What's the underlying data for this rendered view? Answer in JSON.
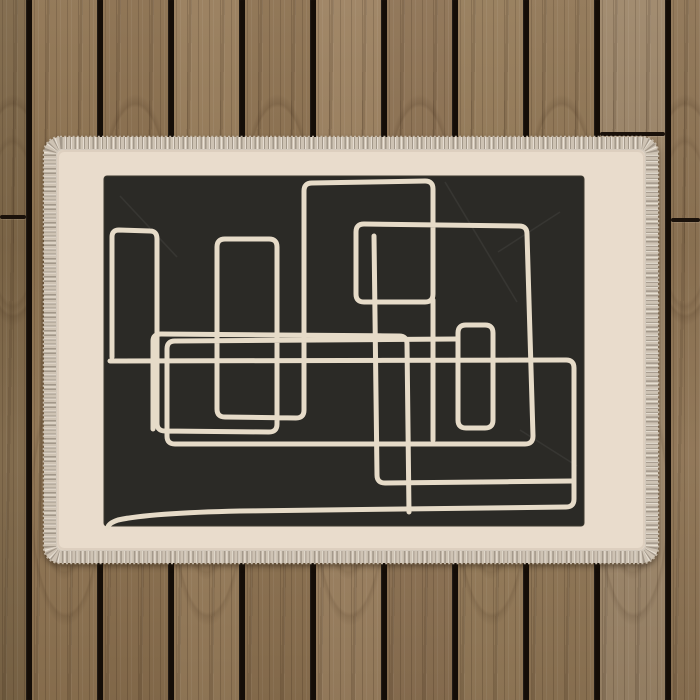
{
  "scene": {
    "description": "Abstract single-line art rug with black canvas and cream border, photographed on a brown wooden deck of vertical planks",
    "wood": {
      "gap_color": "#140d07",
      "gap_width": 6,
      "seam_color": "#1a110a",
      "planks": [
        {
          "x": 0,
          "w": 26,
          "color": "#7e6748"
        },
        {
          "x": 32,
          "w": 65,
          "color": "#8f7452"
        },
        {
          "x": 103,
          "w": 65,
          "color": "#8a6f4e"
        },
        {
          "x": 174,
          "w": 65,
          "color": "#977c5a"
        },
        {
          "x": 245,
          "w": 65,
          "color": "#8c7150"
        },
        {
          "x": 316,
          "w": 65,
          "color": "#9c8160"
        },
        {
          "x": 387,
          "w": 65,
          "color": "#8d7253"
        },
        {
          "x": 458,
          "w": 65,
          "color": "#957b59"
        },
        {
          "x": 529,
          "w": 65,
          "color": "#907655"
        },
        {
          "x": 600,
          "w": 65,
          "color": "#9d8669"
        },
        {
          "x": 671,
          "w": 29,
          "color": "#8e7454"
        }
      ],
      "gap_centers": [
        29,
        100,
        171,
        242,
        313,
        384,
        455,
        526,
        597,
        668
      ],
      "seams": [
        {
          "plank_index": 0,
          "y": 215
        },
        {
          "plank_index": 9,
          "y": 132
        },
        {
          "plank_index": 10,
          "y": 218
        }
      ]
    },
    "rug": {
      "outer": {
        "x": 44,
        "y": 137,
        "w": 614,
        "h": 426,
        "rx": 16
      },
      "fringe_color": "#d3c9bc",
      "fringe_edge_color": "#c4b8a7",
      "stitch_band": {
        "x": 50,
        "y": 143,
        "w": 602,
        "h": 414,
        "rx": 11,
        "width": 12,
        "base_color": "#cec3b4",
        "tick_color": "#a3988a",
        "highlight_color": "#f0e9dd"
      },
      "border_field": {
        "x": 57,
        "y": 150,
        "w": 588,
        "h": 400,
        "rx": 6,
        "color": "#e9dccc"
      },
      "canvas": {
        "x": 104,
        "y": 176,
        "w": 480,
        "h": 350,
        "rx": 3,
        "color": "#2b2a26",
        "edge_color": "#3c392f"
      },
      "line_color": "#e6dbc8",
      "line_width": 5,
      "art_paths": [
        "M 112,357 L 112,237 Q 112,230 119,230 L 150,231 Q 157,231 157,239 L 157,423 Q 157,431 165,431 L 269,432 Q 277,432 277,424 L 277,247 Q 277,239 269,239 L 225,239 Q 217,239 217,247 L 217,409 Q 217,417 225,417 L 296,418 Q 304,418 304,410 L 304,191 Q 304,183 312,183 L 425,181 Q 433,181 433,189 L 433,294 Q 433,302 425,302 L 364,302 Q 356,302 356,294 L 356,232 Q 356,224 364,224 L 519,226 Q 527,226 527,234 L 533,436 Q 533,444 525,444 L 175,444 Q 167,444 167,436 L 167,349 Q 167,341 175,341 L 456,339",
        "M 153,429 L 153,341 Q 153,334 161,334 L 399,336 Q 407,336 407,344 L 409,512",
        "M 374,236 L 377,475 Q 377,483 385,483 L 572,481",
        "M 110,361 L 566,360 Q 574,360 574,368 L 574,499 Q 574,507 566,507 L 240,511 Q 150,513 118,520 Q 109,523 108,527",
        "M 433,300 L 433,440",
        "M 458,333 Q 458,325 466,325 L 485,325 Q 493,325 493,333 L 493,420 Q 493,428 485,428 L 466,428 Q 458,428 458,420 Z"
      ],
      "crease_color": "#ffffff",
      "crease_paths": [
        "M 445,182 L 517,302",
        "M 498,252 L 560,212",
        "M 520,430 L 577,466",
        "M 120,196 L 177,257"
      ]
    }
  }
}
